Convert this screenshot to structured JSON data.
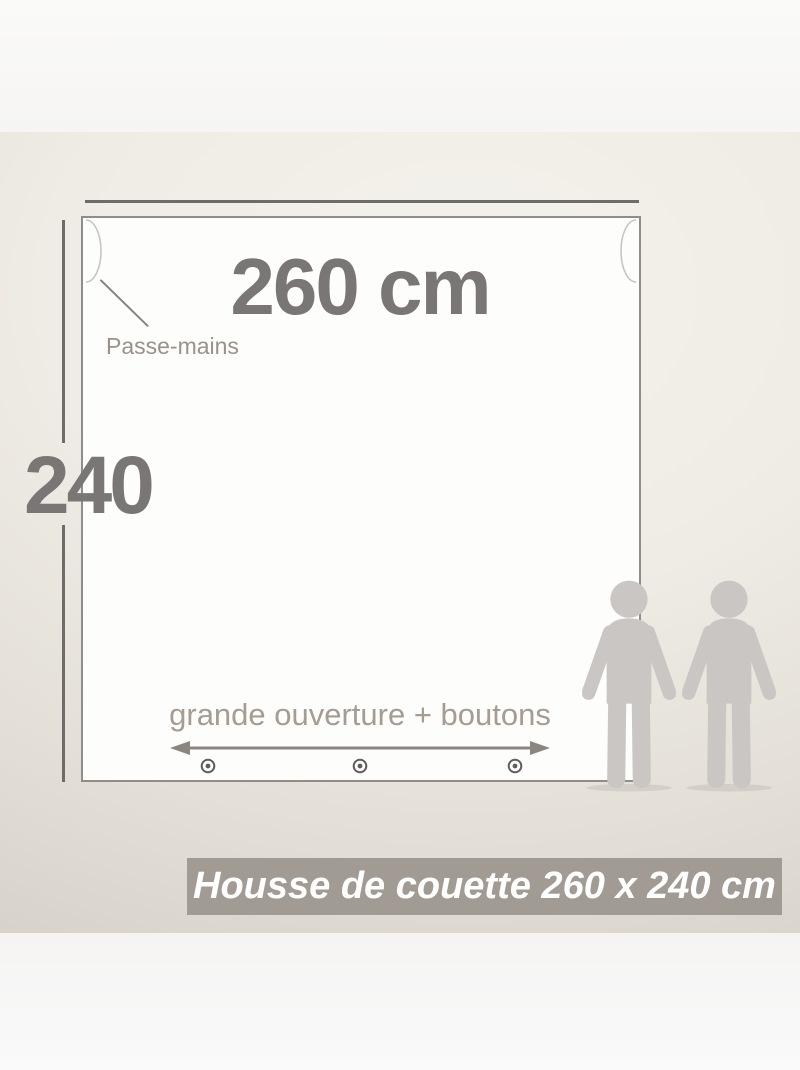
{
  "diagram": {
    "width_dimension_label": "260 cm",
    "width_cm": 260,
    "height_dimension_label": "240",
    "height_cm": 240,
    "hand_slot_label": "Passe-mains",
    "opening_label": "grande ouverture + boutons",
    "button_count": 3,
    "caption": "Housse de couette 260 x 240 cm"
  },
  "icons": {
    "hand_slot_left": "hand-slot-notch",
    "hand_slot_right": "hand-slot-notch",
    "opening_arrow": "double-headed-arrow",
    "button": "button-circle",
    "people": "two-person-pictogram"
  },
  "colors": {
    "dimension_text": "#7b7676",
    "dimension_line": "#6f6b69",
    "label_text": "#9b9189",
    "opening_text": "#a69c92",
    "arrow": "#8a8580",
    "button": "#615d5a",
    "banner_background": "#a19b93",
    "banner_text": "#ffffff",
    "person": "#c9c6c3",
    "box_border": "#8f8c89",
    "box_fill": "#fdfdfc"
  }
}
